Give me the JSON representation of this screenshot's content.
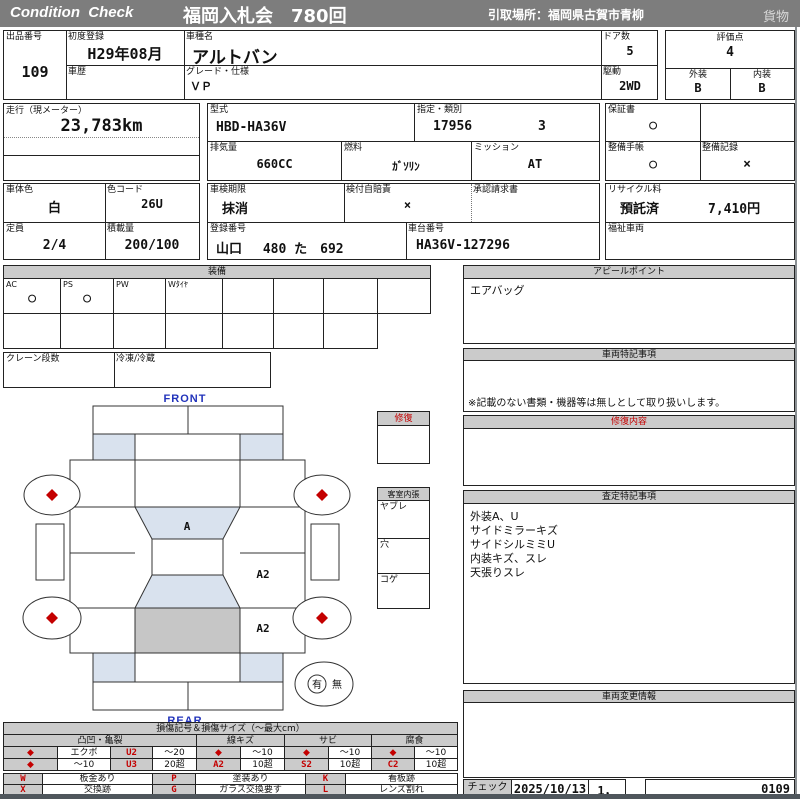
{
  "colors": {
    "accent_red": "#c40000",
    "header_grey": "#7d7d7d",
    "panel_grey": "#cbcbcb",
    "glass_blue": "#d9e2ee",
    "gate_grey": "#c6c6c6",
    "front_rear_blue": "#2233bb"
  },
  "header": {
    "brand": "Condition  Check",
    "title": "福岡入札会　780回",
    "pickup": "引取場所：福岡県古賀市青柳",
    "cargo": "貨物"
  },
  "info": {
    "lot": {
      "label": "出品番号",
      "value": "109"
    },
    "first_reg": {
      "label": "初度登録",
      "value": "H29年08月"
    },
    "history": {
      "label": "車歴",
      "value": ""
    },
    "model_name": {
      "label": "車種名",
      "value": "アルトバン"
    },
    "grade": {
      "label": "グレード・仕様",
      "value": "ＶＰ"
    },
    "doors": {
      "label": "ドア数",
      "value": "5"
    },
    "drive": {
      "label": "駆動",
      "value": "2WD"
    },
    "score": {
      "label": "評価点",
      "value": "4"
    },
    "exterior": {
      "label": "外装",
      "value": "B"
    },
    "interior": {
      "label": "内装",
      "value": "B"
    },
    "mileage": {
      "label": "走行（現メーター）",
      "value": "23,783km"
    },
    "model_code": {
      "label": "型式",
      "value": "HBD-HA36V"
    },
    "class_no": {
      "label": "指定・類別",
      "value1": "17956",
      "value2": "3"
    },
    "displacement": {
      "label": "排気量",
      "value": "660CC"
    },
    "fuel": {
      "label": "燃料",
      "value": "ｶﾞｿﾘﾝ"
    },
    "transmission": {
      "label": "ミッション",
      "value": "AT"
    },
    "warranty": {
      "label": "保証書",
      "value": "○"
    },
    "maintenance_book": {
      "label": "整備手帳",
      "value": "○"
    },
    "maintenance_record": {
      "label": "整備記録",
      "value": "×"
    },
    "body_color": {
      "label": "車体色",
      "value": "白"
    },
    "color_code": {
      "label": "色コード",
      "value": "26U"
    },
    "inspection": {
      "label": "車検期限",
      "value": "抹消"
    },
    "insurance": {
      "label": "検付自賠責",
      "value": "×"
    },
    "approval": {
      "label": "承認請求書",
      "value": ""
    },
    "recycle": {
      "label": "リサイクル料",
      "value": "預託済",
      "amount": "7,410円"
    },
    "capacity": {
      "label": "定員",
      "value": "2/4"
    },
    "load": {
      "label": "積載量",
      "value": "200/100"
    },
    "reg_no": {
      "label": "登録番号",
      "value": "山口　 480 た　692"
    },
    "chassis_no": {
      "label": "車台番号",
      "value": "HA36V-127296"
    },
    "welfare": {
      "label": "福祉車両",
      "value": ""
    }
  },
  "equipment": {
    "title": "装備",
    "row1": [
      {
        "label": "AC",
        "value": "○"
      },
      {
        "label": "PS",
        "value": "○"
      },
      {
        "label": "PW",
        "value": ""
      },
      {
        "label": "Wﾀｲﾔ",
        "value": ""
      },
      {
        "label": "",
        "value": ""
      },
      {
        "label": "",
        "value": ""
      },
      {
        "label": "",
        "value": ""
      },
      {
        "label": "",
        "value": ""
      }
    ],
    "crane_label": "クレーン段数",
    "reefer_label": "冷凍/冷蔵"
  },
  "panels": {
    "appeal": {
      "title": "アピールポイント",
      "body": "エアバッグ"
    },
    "special_notes": {
      "title": "車両特記事項",
      "note": "※記載のない書類・機器等は無しとして取り扱いします。"
    },
    "repair_detail": {
      "title": "修復内容",
      "body": ""
    },
    "assessment_notes": {
      "title": "査定特記事項",
      "lines": [
        "外装A、U",
        "サイドミラーキズ",
        "サイドシルミミU",
        "内装キズ、スレ",
        "天張りスレ"
      ]
    },
    "change_info": {
      "title": "車両変更情報",
      "body": ""
    },
    "repair_box": {
      "title": "修復"
    },
    "cabin": {
      "title": "客室内張",
      "rows": [
        "ヤブレ",
        "穴",
        "コゲ"
      ]
    }
  },
  "diagram": {
    "front": "FRONT",
    "rear": "REAR",
    "glass_mark": "A",
    "panel_mark_1": "A2",
    "panel_mark_2": "A2",
    "spare_yes": "有",
    "spare_no": "無"
  },
  "legend": {
    "title": "損傷記号＆損傷サイズ（～最大cm）",
    "group1": "凸凹・亀裂",
    "group2": "線キズ",
    "group3": "サビ",
    "group4": "腐食",
    "dent_r1": [
      "◆",
      "エクボ",
      "U2",
      "～20"
    ],
    "dent_r2": [
      "◆",
      "～10",
      "U3",
      "20超"
    ],
    "line_r1": [
      "◆",
      "～10"
    ],
    "line_r2": [
      "A2",
      "10超"
    ],
    "rust_r1": [
      "◆",
      "～10"
    ],
    "rust_r2": [
      "S2",
      "10超"
    ],
    "corr_r1": [
      "◆",
      "～10"
    ],
    "corr_r2": [
      "C2",
      "10超"
    ],
    "codes_r1": [
      {
        "c": "W",
        "d": "板金あり"
      },
      {
        "c": "P",
        "d": "塗装あり"
      },
      {
        "c": "K",
        "d": "看板跡"
      }
    ],
    "codes_r2": [
      {
        "c": "X",
        "d": "交換跡"
      },
      {
        "c": "G",
        "d": "ガラス交換要す"
      },
      {
        "c": "L",
        "d": "レンズ割れ"
      }
    ]
  },
  "footer": {
    "check": "チェック",
    "date": "2025/10/13",
    "count": "1，",
    "code": "0109"
  }
}
